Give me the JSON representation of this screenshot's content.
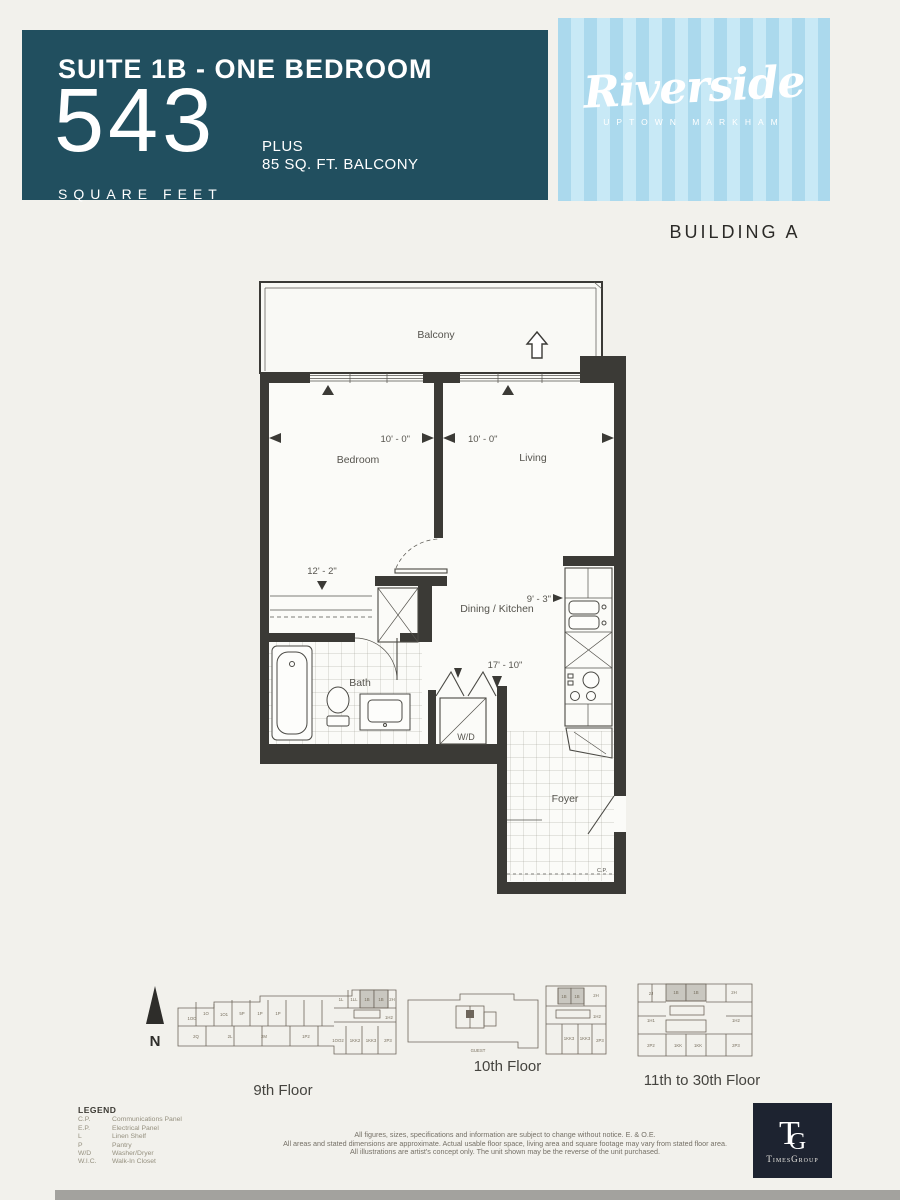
{
  "header": {
    "suite_title": "SUITE 1B - ONE BEDROOM",
    "sqft": "543",
    "plus": "PLUS",
    "balcony_note": "85 SQ. FT. BALCONY",
    "sqft_label": "SQUARE FEET"
  },
  "brand": {
    "name": "Riverside",
    "subtitle": "UPTOWN MARKHAM"
  },
  "building": "BUILDING A",
  "floorplan": {
    "labels": {
      "balcony": "Balcony",
      "bedroom": "Bedroom",
      "living": "Living",
      "dining_kitchen": "Dining / Kitchen",
      "bath": "Bath",
      "wd": "W/D",
      "foyer": "Foyer",
      "cp": "C.P."
    },
    "dimensions": {
      "bedroom_width": "10' - 0\"",
      "living_width": "10' - 0\"",
      "bedroom_length": "12' - 2\"",
      "kitchen_width": "9' - 3\"",
      "unit_length": "17' - 10\""
    }
  },
  "keyplans": {
    "north_label": "N",
    "floor9": {
      "caption": "9th Floor",
      "units": {
        "u1": "1OO",
        "u2": "1O",
        "u3": "1O1",
        "u4": "5P",
        "u5": "1P",
        "u6": "1P",
        "u7": "1L",
        "u8": "1LL",
        "u9": "1B",
        "u10": "1B",
        "u11": "2H",
        "u12": "2Q",
        "u13": "2L",
        "u14": "2M",
        "u15": "1P2",
        "u16": "1OO2",
        "u17": "1KK2",
        "u18": "1KK3",
        "u19": "2P3",
        "u20": "1H2"
      }
    },
    "floor10": {
      "caption": "10th Floor",
      "guest": "GUEST",
      "units": {
        "u1": "1B",
        "u2": "1B",
        "u3": "2H",
        "u4": "1H2",
        "u5": "1KK3",
        "u6": "1KK3",
        "u7": "2P3"
      }
    },
    "floor11_30": {
      "caption": "11th to 30th Floor",
      "units": {
        "u1": "2J",
        "u2": "1B",
        "u3": "1B",
        "u4": "2H",
        "u5": "1H1",
        "u6": "1H2",
        "u7": "2P2",
        "u8": "1KK",
        "u9": "1KK",
        "u10": "2P3"
      }
    }
  },
  "legend": {
    "title": "LEGEND",
    "items": [
      {
        "abbr": "C.P.",
        "label": "Communications Panel"
      },
      {
        "abbr": "E.P.",
        "label": "Electrical Panel"
      },
      {
        "abbr": "L",
        "label": "Linen Shelf"
      },
      {
        "abbr": "P",
        "label": "Pantry"
      },
      {
        "abbr": "W/D",
        "label": "Washer/Dryer"
      },
      {
        "abbr": "W.I.C.",
        "label": "Walk-In Closet"
      }
    ]
  },
  "disclaimer": {
    "line1": "All figures, sizes, specifications and information are subject to change without notice. E. & O.E.",
    "line2": "All areas and stated dimensions are approximate. Actual usable floor space, living area and square footage may vary from stated floor area.",
    "line3": "All illustrations are artist's concept only. The unit shown may be the reverse of the unit purchased."
  },
  "logo": {
    "t": "T",
    "g": "G",
    "name": "TimesGroup"
  },
  "colors": {
    "header_bg": "#214f5f",
    "stripe_light": "#c8e9f6",
    "stripe_dark": "#abd9ed",
    "highlight_unit": "#c9c7c0",
    "plan_line": "#3b3a36"
  }
}
